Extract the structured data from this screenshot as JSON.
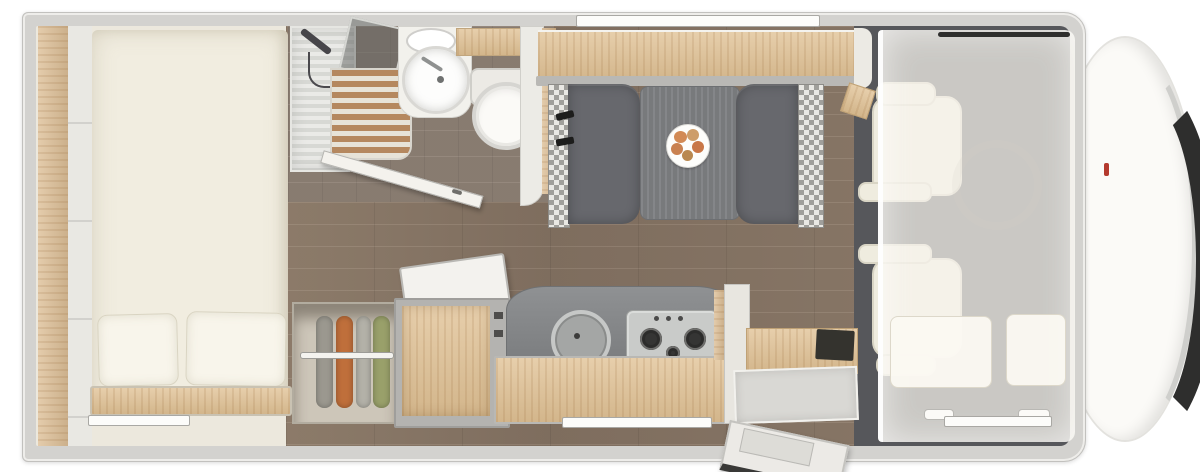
{
  "meta": {
    "title": "Motorhome floor plan - top view",
    "view": "overhead cutaway",
    "type": "floor-plan-rendering",
    "text_visible": "none"
  },
  "palette": {
    "background": "#ffffff",
    "body_wall": "#d3d2cf",
    "interior_wall": "#ece8dd",
    "wood_light": "#e0c194",
    "wood_floor": "#8a786a",
    "bathroom_floor": "#8f8276",
    "cab_floor": "#56575b",
    "mattress": "#f1ede0",
    "pillow": "#f8f5eb",
    "dinette_seat": "#67686d",
    "table_top": "#7e8083",
    "cab_seat": "#efecdf",
    "stainless": "#c9cbc9",
    "glass_dark": "#5e605e",
    "door_trim": "#393937",
    "windshield": "#2e2e2d",
    "nose_white": "#fbfaf7",
    "accent_red": "#b43a2e",
    "cloth_orange": "#bf6f3b",
    "cloth_green": "#99a06a",
    "cloth_gray": "#9b988f",
    "food_tone": "#cd8a55"
  },
  "zones": {
    "rear_bed": "rear-bed-with-pillows",
    "wardrobe": "wardrobe-hanging-clothes",
    "bathroom": "shower-washbasin-toilet",
    "dinette": "face-to-face-dinette-with-table",
    "kitchen": "sink-and-3-burner-hob",
    "storage_chest": "open-lid-storage-chest",
    "entry": "open-entry-door",
    "cab": "two-swivel-seats-under-drop-down-bed",
    "front": "vehicle-nose-with-windshield"
  }
}
